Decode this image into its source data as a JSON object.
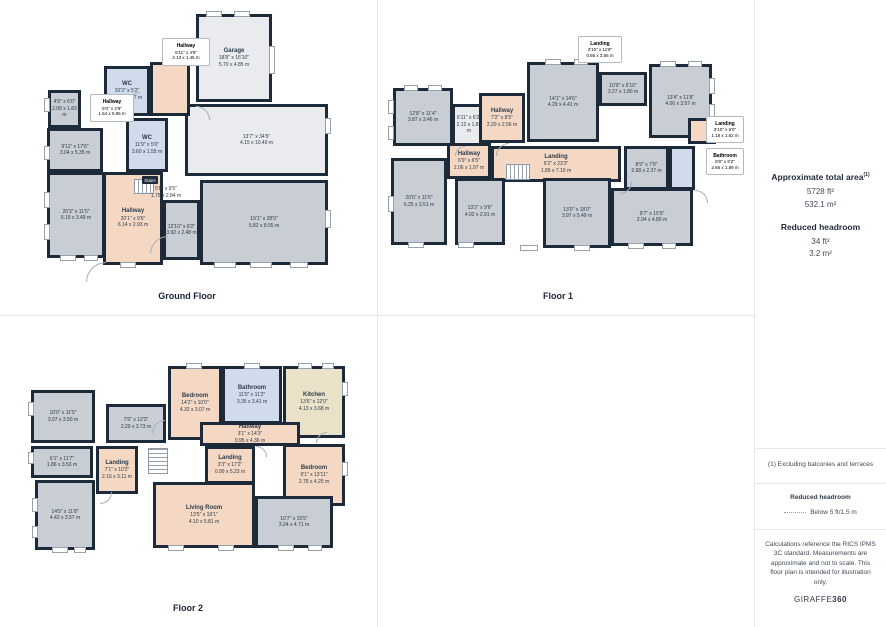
{
  "palette": {
    "wall": "#1c2a3a",
    "room_grey": "#c9cdd4",
    "room_light": "#e9ebee",
    "room_peach": "#f4d8c4",
    "room_blue": "#d0dbeb",
    "room_tan": "#e9e1c8",
    "divider": "#e3e6ea",
    "text": "#2d3b4a"
  },
  "sidebar": {
    "area_title": "Approximate total area",
    "area_title_sup": "(1)",
    "area_ft": "5728 ft²",
    "area_m": "532.1 m²",
    "headroom_title": "Reduced headroom",
    "headroom_ft": "34 ft²",
    "headroom_m": "3.2 m²",
    "footnote": "(1) Excluding balconies and terraces",
    "legend_title": "Reduced headroom",
    "legend_label": "Below 5 ft/1.5 m",
    "disclaimer": "Calculations reference the RICS IPMS 3C standard. Measurements are approximate and not to scale. This floor plan is intended for illustration only.",
    "logo_normal": "GIRAFFE",
    "logo_bold": "360"
  },
  "floors": [
    {
      "title": "Ground Floor",
      "title_x": 187,
      "title_y": 291,
      "rooms": [
        {
          "name": "Garage",
          "ft": "18'8\" x 16'10\"",
          "m": "5.70 x 4.85 m",
          "x": 196,
          "y": 14,
          "w": 76,
          "h": 88,
          "fill": "light"
        },
        {
          "ft": "13'7\" x 34'5\"",
          "m": "4.15 x 10.49 m",
          "x": 185,
          "y": 104,
          "w": 143,
          "h": 72,
          "fill": "light"
        },
        {
          "ft": "4'9\" x 6'0\"",
          "m": "2.08 x 1.83 m",
          "x": 48,
          "y": 90,
          "w": 33,
          "h": 38,
          "fill": "grey"
        },
        {
          "ft": "9'11\" x 17'6\"",
          "m": "3.04 x 5.35 m",
          "x": 47,
          "y": 128,
          "w": 56,
          "h": 44,
          "fill": "grey"
        },
        {
          "ft": "20'3\" x 11'5\"",
          "m": "6.19 x 3.49 m",
          "x": 47,
          "y": 172,
          "w": 58,
          "h": 86,
          "fill": "grey"
        },
        {
          "name": "WC",
          "ft": "10'3\" x 5'2\"",
          "m": "3.13 x 1.57 m",
          "x": 104,
          "y": 66,
          "w": 46,
          "h": 50,
          "fill": "blue"
        },
        {
          "name": "WC",
          "ft": "11'9\" x 5'0\"",
          "m": "3.60 x 1.55 m",
          "x": 126,
          "y": 118,
          "w": 42,
          "h": 54,
          "fill": "blue"
        },
        {
          "x": 150,
          "y": 62,
          "w": 40,
          "h": 54,
          "fill": "peach"
        },
        {
          "name": "Hallway",
          "ft": "20'1\" x 9'6\"",
          "m": "6.14 x 2.93 m",
          "x": 103,
          "y": 172,
          "w": 60,
          "h": 93,
          "fill": "peach"
        },
        {
          "ft": "12'10\" x 8'2\"",
          "m": "3.92 x 2.48 m",
          "x": 163,
          "y": 200,
          "w": 37,
          "h": 60,
          "fill": "grey"
        },
        {
          "ft": "19'1\" x 28'0\"",
          "m": "5.82 x 8.55 m",
          "x": 200,
          "y": 180,
          "w": 128,
          "h": 85,
          "fill": "grey"
        }
      ],
      "callouts": [
        {
          "name": "Hallway",
          "ft": "6'11\" x 4'9\"",
          "m": "2.13 x 1.45 m",
          "x": 162,
          "y": 38,
          "w": 46,
          "h": 26
        },
        {
          "name": "Hallway",
          "ft": "5'0\" x 2'9\"",
          "m": "1.54 x 0.86 m",
          "x": 90,
          "y": 94,
          "w": 42,
          "h": 26
        }
      ],
      "badges": [
        {
          "label": "Stairs",
          "x": 142,
          "y": 176,
          "w": 16,
          "h": 8
        }
      ],
      "free_labels": [
        {
          "ft": "5'8\" x 9'5\"",
          "m": "1.75 x 2.84 m",
          "x": 145,
          "y": 186,
          "w": 42
        }
      ],
      "stairs": [
        {
          "x": 134,
          "y": 179,
          "w": 20,
          "h": 15,
          "dir": "h"
        }
      ],
      "windows": [
        {
          "x": 206,
          "y": 11,
          "w": 16,
          "h": 6
        },
        {
          "x": 234,
          "y": 11,
          "w": 16,
          "h": 6
        },
        {
          "x": 44,
          "y": 98,
          "w": 6,
          "h": 14
        },
        {
          "x": 44,
          "y": 146,
          "w": 6,
          "h": 14
        },
        {
          "x": 44,
          "y": 192,
          "w": 6,
          "h": 16
        },
        {
          "x": 44,
          "y": 224,
          "w": 6,
          "h": 16
        },
        {
          "x": 60,
          "y": 255,
          "w": 16,
          "h": 6
        },
        {
          "x": 84,
          "y": 255,
          "w": 14,
          "h": 6
        },
        {
          "x": 120,
          "y": 262,
          "w": 16,
          "h": 6
        },
        {
          "x": 214,
          "y": 262,
          "w": 22,
          "h": 6
        },
        {
          "x": 250,
          "y": 262,
          "w": 22,
          "h": 6
        },
        {
          "x": 290,
          "y": 262,
          "w": 18,
          "h": 6
        },
        {
          "x": 325,
          "y": 118,
          "w": 6,
          "h": 16
        },
        {
          "x": 325,
          "y": 210,
          "w": 6,
          "h": 18
        },
        {
          "x": 269,
          "y": 46,
          "w": 6,
          "h": 28
        }
      ],
      "doors": [
        {
          "x": 150,
          "y": 236,
          "r": 18,
          "rot": 0
        },
        {
          "x": 86,
          "y": 262,
          "r": 20,
          "rot": 0
        },
        {
          "x": 196,
          "y": 106,
          "r": 14,
          "rot": 90
        },
        {
          "x": 128,
          "y": 92,
          "r": 12,
          "rot": 0
        }
      ]
    },
    {
      "title": "Floor 1",
      "title_x": 558,
      "title_y": 291,
      "rooms": [
        {
          "ft": "12'8\" x 11'4\"",
          "m": "3.87 x 3.46 m",
          "x": 393,
          "y": 88,
          "w": 60,
          "h": 58,
          "fill": "grey"
        },
        {
          "ft": "20'6\" x 11'6\"",
          "m": "6.25 x 3.51 m",
          "x": 391,
          "y": 158,
          "w": 56,
          "h": 87,
          "fill": "grey"
        },
        {
          "ft": "6'11\" x 6'2\"",
          "m": "2.12 x 1.88 m",
          "x": 452,
          "y": 104,
          "w": 34,
          "h": 42,
          "fill": "light"
        },
        {
          "name": "Hallway",
          "ft": "7'2\" x 8'5\"",
          "m": "2.20 x 2.56 m",
          "x": 479,
          "y": 93,
          "w": 46,
          "h": 50,
          "fill": "peach"
        },
        {
          "name": "Hallway",
          "ft": "6'9\" x 6'5\"",
          "m": "2.06 x 1.97 m",
          "x": 447,
          "y": 143,
          "w": 44,
          "h": 36,
          "fill": "peach"
        },
        {
          "name": "Landing",
          "ft": "6'2\" x 23'3\"",
          "m": "1.89 x 7.10 m",
          "x": 491,
          "y": 146,
          "w": 130,
          "h": 36,
          "fill": "peach"
        },
        {
          "ft": "14'1\" x 14'6\"",
          "m": "4.29 x 4.41 m",
          "x": 527,
          "y": 62,
          "w": 72,
          "h": 80,
          "fill": "grey"
        },
        {
          "ft": "10'9\" x 5'10\"",
          "m": "3.27 x 1.80 m",
          "x": 599,
          "y": 72,
          "w": 48,
          "h": 34,
          "fill": "grey"
        },
        {
          "ft": "13'4\" x 11'8\"",
          "m": "4.06 x 3.57 m",
          "x": 649,
          "y": 64,
          "w": 63,
          "h": 74,
          "fill": "grey"
        },
        {
          "ft": "8'9\" x 7'9\"",
          "m": "2.68 x 2.37 m",
          "x": 624,
          "y": 146,
          "w": 45,
          "h": 44,
          "fill": "grey"
        },
        {
          "x": 669,
          "y": 146,
          "w": 26,
          "h": 44,
          "fill": "blue"
        },
        {
          "x": 688,
          "y": 118,
          "w": 28,
          "h": 26,
          "fill": "peach"
        },
        {
          "ft": "13'2\" x 9'6\"",
          "m": "4.02 x 2.91 m",
          "x": 455,
          "y": 178,
          "w": 50,
          "h": 67,
          "fill": "grey"
        },
        {
          "ft": "13'0\" x 18'0\"",
          "m": "3.97 x 5.49 m",
          "x": 543,
          "y": 178,
          "w": 68,
          "h": 70,
          "fill": "grey"
        },
        {
          "ft": "9'7\" x 15'9\"",
          "m": "2.94 x 4.80 m",
          "x": 611,
          "y": 188,
          "w": 82,
          "h": 58,
          "fill": "grey"
        }
      ],
      "callouts": [
        {
          "name": "Landing",
          "ft": "2'10\" x 11'8\"",
          "m": "0.86 x 3.56 m",
          "x": 578,
          "y": 36,
          "w": 42,
          "h": 25
        },
        {
          "name": "Landing",
          "ft": "3'10\" x 6'0\"",
          "m": "1.18 x 1.82 m",
          "x": 706,
          "y": 116,
          "w": 36,
          "h": 25
        },
        {
          "name": "Bathroom",
          "ft": "8'8\" x 6'2\"",
          "m": "2.66 x 1.89 m",
          "x": 706,
          "y": 148,
          "w": 36,
          "h": 25
        }
      ],
      "badges": [],
      "free_labels": [],
      "stairs": [
        {
          "x": 506,
          "y": 164,
          "w": 24,
          "h": 16,
          "dir": "h"
        }
      ],
      "windows": [
        {
          "x": 388,
          "y": 100,
          "w": 6,
          "h": 14
        },
        {
          "x": 388,
          "y": 126,
          "w": 6,
          "h": 14
        },
        {
          "x": 388,
          "y": 196,
          "w": 6,
          "h": 16
        },
        {
          "x": 404,
          "y": 85,
          "w": 14,
          "h": 6
        },
        {
          "x": 428,
          "y": 85,
          "w": 14,
          "h": 6
        },
        {
          "x": 545,
          "y": 59,
          "w": 16,
          "h": 6
        },
        {
          "x": 574,
          "y": 59,
          "w": 14,
          "h": 6
        },
        {
          "x": 660,
          "y": 61,
          "w": 16,
          "h": 6
        },
        {
          "x": 688,
          "y": 61,
          "w": 14,
          "h": 6
        },
        {
          "x": 709,
          "y": 78,
          "w": 6,
          "h": 16
        },
        {
          "x": 709,
          "y": 104,
          "w": 6,
          "h": 14
        },
        {
          "x": 408,
          "y": 242,
          "w": 16,
          "h": 6
        },
        {
          "x": 458,
          "y": 242,
          "w": 16,
          "h": 6
        },
        {
          "x": 520,
          "y": 245,
          "w": 18,
          "h": 6
        },
        {
          "x": 574,
          "y": 245,
          "w": 16,
          "h": 6
        },
        {
          "x": 628,
          "y": 243,
          "w": 16,
          "h": 6
        },
        {
          "x": 662,
          "y": 243,
          "w": 14,
          "h": 6
        }
      ],
      "doors": [
        {
          "x": 496,
          "y": 143,
          "r": 13,
          "rot": 0
        },
        {
          "x": 455,
          "y": 146,
          "r": 10,
          "rot": 0
        },
        {
          "x": 620,
          "y": 182,
          "r": 12,
          "rot": 180
        },
        {
          "x": 695,
          "y": 190,
          "r": 13,
          "rot": 90
        }
      ]
    },
    {
      "title": "Floor 2",
      "title_x": 188,
      "title_y": 603,
      "rooms": [
        {
          "name": "Bedroom",
          "ft": "14'2\" x 10'0\"",
          "m": "4.32 x 3.07 m",
          "x": 168,
          "y": 366,
          "w": 54,
          "h": 74,
          "fill": "peach"
        },
        {
          "name": "Bathroom",
          "ft": "11'0\" x 11'2\"",
          "m": "3.35 x 3.41 m",
          "x": 222,
          "y": 366,
          "w": 60,
          "h": 58,
          "fill": "blue"
        },
        {
          "name": "Kitchen",
          "ft": "13'6\" x 12'0\"",
          "m": "4.13 x 3.68 m",
          "x": 283,
          "y": 366,
          "w": 62,
          "h": 72,
          "fill": "tan"
        },
        {
          "name": "Hallway",
          "ft": "3'1\" x 14'3\"",
          "m": "0.95 x 4.36 m",
          "x": 200,
          "y": 422,
          "w": 100,
          "h": 24,
          "fill": "peach"
        },
        {
          "name": "Landing",
          "ft": "3'3\" x 17'2\"",
          "m": "0.99 x 5.23 m",
          "x": 205,
          "y": 446,
          "w": 50,
          "h": 38,
          "fill": "peach"
        },
        {
          "name": "Bedroom",
          "ft": "9'1\" x 13'11\"",
          "m": "2.78 x 4.25 m",
          "x": 283,
          "y": 444,
          "w": 62,
          "h": 62,
          "fill": "peach"
        },
        {
          "name": "Living Room",
          "ft": "13'5\" x 19'1\"",
          "m": "4.10 x 5.81 m",
          "x": 153,
          "y": 482,
          "w": 102,
          "h": 66,
          "fill": "peach"
        },
        {
          "ft": "10'7\" x 15'5\"",
          "m": "3.24 x 4.71 m",
          "x": 255,
          "y": 496,
          "w": 78,
          "h": 52,
          "fill": "grey"
        },
        {
          "ft": "10'0\" x 11'5\"",
          "m": "3.07 x 3.50 m",
          "x": 31,
          "y": 390,
          "w": 64,
          "h": 53,
          "fill": "grey"
        },
        {
          "ft": "7'6\" x 12'3\"",
          "m": "2.29 x 3.73 m",
          "x": 106,
          "y": 404,
          "w": 60,
          "h": 39,
          "fill": "grey"
        },
        {
          "ft": "6'1\" x 11'7\"",
          "m": "1.86 x 3.53 m",
          "x": 31,
          "y": 446,
          "w": 62,
          "h": 32,
          "fill": "grey"
        },
        {
          "name": "Landing",
          "ft": "7'1\" x 10'2\"",
          "m": "2.16 x 3.11 m",
          "x": 96,
          "y": 446,
          "w": 42,
          "h": 48,
          "fill": "peach"
        },
        {
          "ft": "14'5\" x 11'8\"",
          "m": "4.42 x 3.57 m",
          "x": 35,
          "y": 480,
          "w": 60,
          "h": 70,
          "fill": "grey"
        }
      ],
      "callouts": [],
      "badges": [],
      "free_labels": [],
      "stairs": [
        {
          "x": 148,
          "y": 448,
          "w": 20,
          "h": 26,
          "dir": "v"
        }
      ],
      "windows": [
        {
          "x": 186,
          "y": 363,
          "w": 16,
          "h": 6
        },
        {
          "x": 244,
          "y": 363,
          "w": 16,
          "h": 6
        },
        {
          "x": 298,
          "y": 363,
          "w": 14,
          "h": 6
        },
        {
          "x": 322,
          "y": 363,
          "w": 12,
          "h": 6
        },
        {
          "x": 28,
          "y": 402,
          "w": 6,
          "h": 14
        },
        {
          "x": 28,
          "y": 452,
          "w": 6,
          "h": 12
        },
        {
          "x": 32,
          "y": 498,
          "w": 6,
          "h": 14
        },
        {
          "x": 32,
          "y": 526,
          "w": 6,
          "h": 12
        },
        {
          "x": 52,
          "y": 547,
          "w": 16,
          "h": 6
        },
        {
          "x": 74,
          "y": 547,
          "w": 12,
          "h": 6
        },
        {
          "x": 168,
          "y": 545,
          "w": 16,
          "h": 6
        },
        {
          "x": 218,
          "y": 545,
          "w": 16,
          "h": 6
        },
        {
          "x": 278,
          "y": 545,
          "w": 16,
          "h": 6
        },
        {
          "x": 308,
          "y": 545,
          "w": 14,
          "h": 6
        },
        {
          "x": 342,
          "y": 382,
          "w": 6,
          "h": 14
        },
        {
          "x": 342,
          "y": 462,
          "w": 6,
          "h": 14
        }
      ],
      "doors": [
        {
          "x": 152,
          "y": 420,
          "r": 13,
          "rot": 0
        },
        {
          "x": 256,
          "y": 446,
          "r": 11,
          "rot": 90
        },
        {
          "x": 316,
          "y": 432,
          "r": 11,
          "rot": 0
        },
        {
          "x": 100,
          "y": 492,
          "r": 12,
          "rot": 180
        }
      ]
    }
  ]
}
